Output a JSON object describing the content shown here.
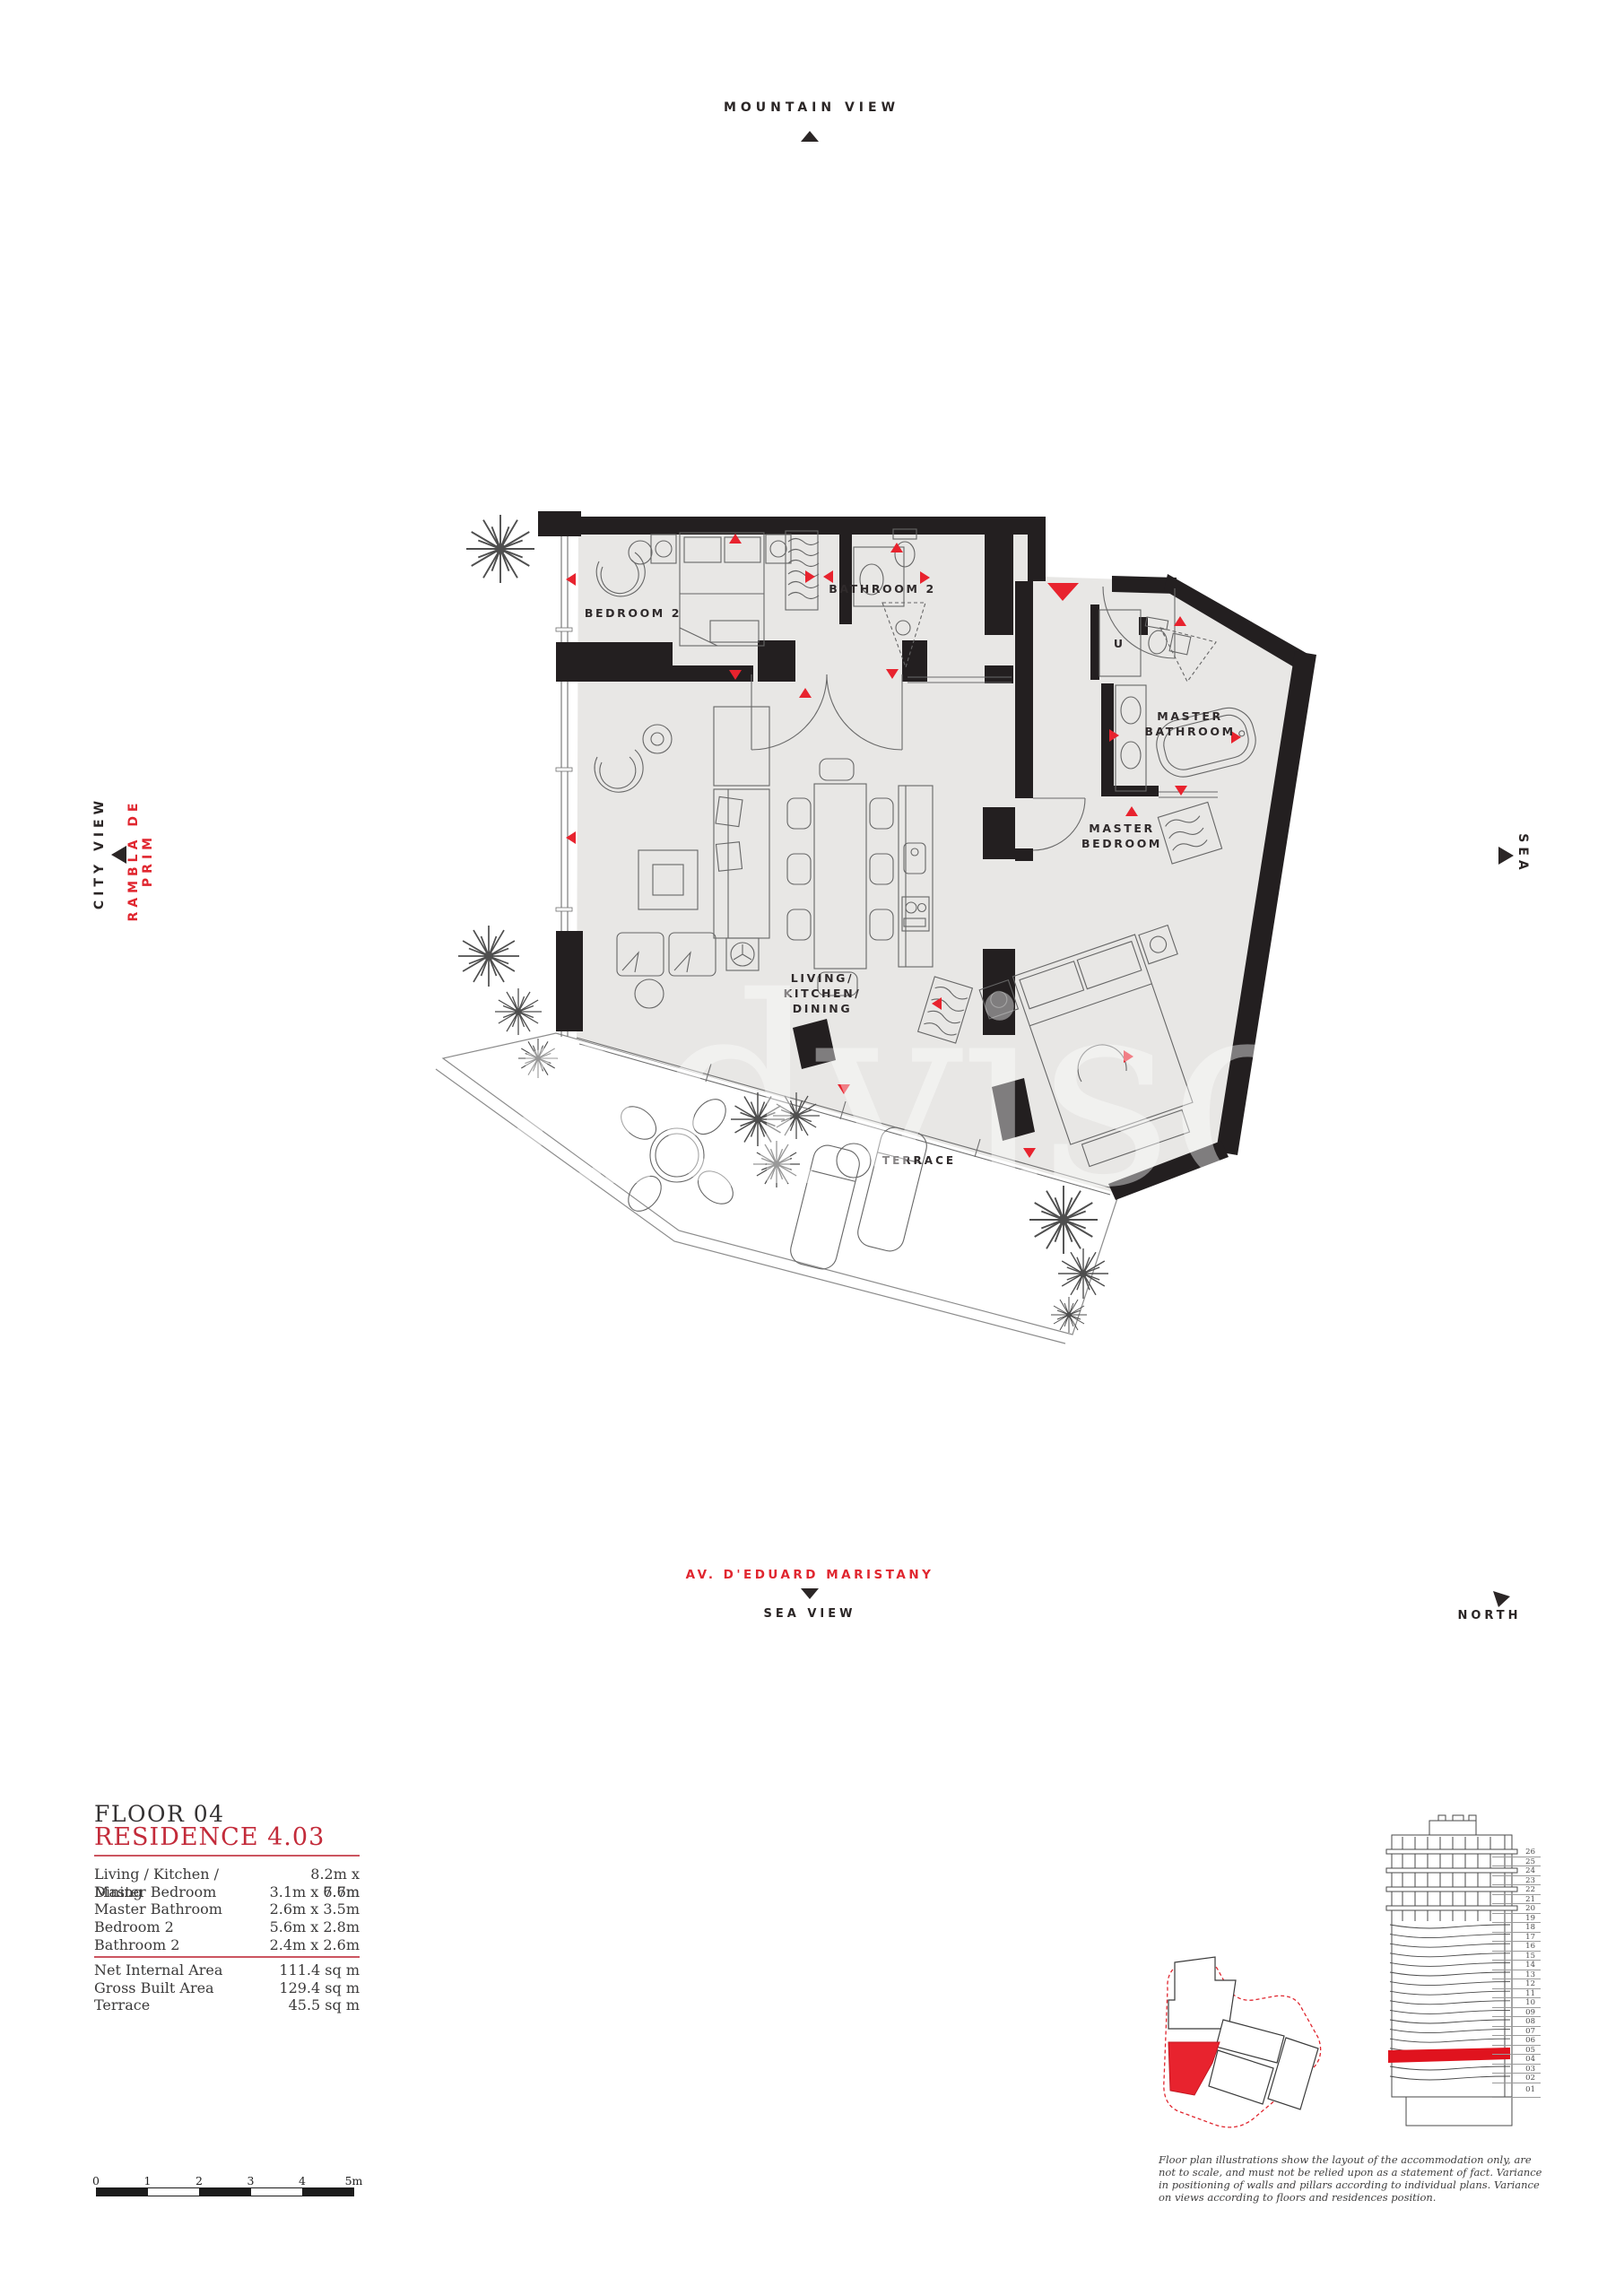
{
  "compass": {
    "mountain_view": "MOUNTAIN VIEW",
    "city_view": "CITY VIEW",
    "rambla": "RAMBLA DE PRIM",
    "sea": "SEA",
    "avenue": "AV. D'EDUARD MARISTANY",
    "sea_view": "SEA VIEW",
    "north": "NORTH"
  },
  "plan": {
    "labels": {
      "bedroom2": "BEDROOM 2",
      "bathroom2": "BATHROOM 2",
      "master_bathroom": "MASTER\nBATHROOM",
      "master_bedroom": "MASTER\nBEDROOM",
      "living": "LIVING/\nKITCHEN/\nDINING",
      "terrace": "TERRACE",
      "utility": "U"
    },
    "watermark": "advisor"
  },
  "info": {
    "floor_label": "FLOOR 04",
    "residence_label": "RESIDENCE 4.03",
    "room_dimensions": [
      {
        "room": "Living / Kitchen / Dining",
        "size": "8.2m x 7.7m"
      },
      {
        "room": "Master Bedroom",
        "size": "3.1m x 6.6m"
      },
      {
        "room": "Master Bathroom",
        "size": "2.6m x 3.5m"
      },
      {
        "room": "Bedroom 2",
        "size": "5.6m x 2.8m"
      },
      {
        "room": "Bathroom 2",
        "size": "2.4m x 2.6m"
      }
    ],
    "areas": [
      {
        "label": "Net Internal Area",
        "value": "111.4 sq m"
      },
      {
        "label": "Gross Built Area",
        "value": "129.4 sq m"
      },
      {
        "label": "Terrace",
        "value": "45.5 sq m"
      }
    ]
  },
  "scale_bar": {
    "labels": [
      "0",
      "1",
      "2",
      "3",
      "4",
      "5m"
    ]
  },
  "tower": {
    "floors": [
      "26",
      "25",
      "24",
      "23",
      "22",
      "21",
      "20",
      "19",
      "18",
      "17",
      "16",
      "15",
      "14",
      "13",
      "12",
      "11",
      "10",
      "09",
      "08",
      "07",
      "06",
      "05",
      "04",
      "03",
      "02",
      "01"
    ],
    "highlighted_floor": "04"
  },
  "colors": {
    "accent_red": "#e0262f",
    "wall_black": "#231f20",
    "floor_gray": "#e8e7e5",
    "rule_red": "#cc5560"
  },
  "disclaimer": "Floor plan illustrations show the layout of the accommodation only, are not to scale, and must not be relied upon as a statement of fact. Variance in positioning of walls and pillars according to individual plans. Variance on views according to floors and residences position."
}
